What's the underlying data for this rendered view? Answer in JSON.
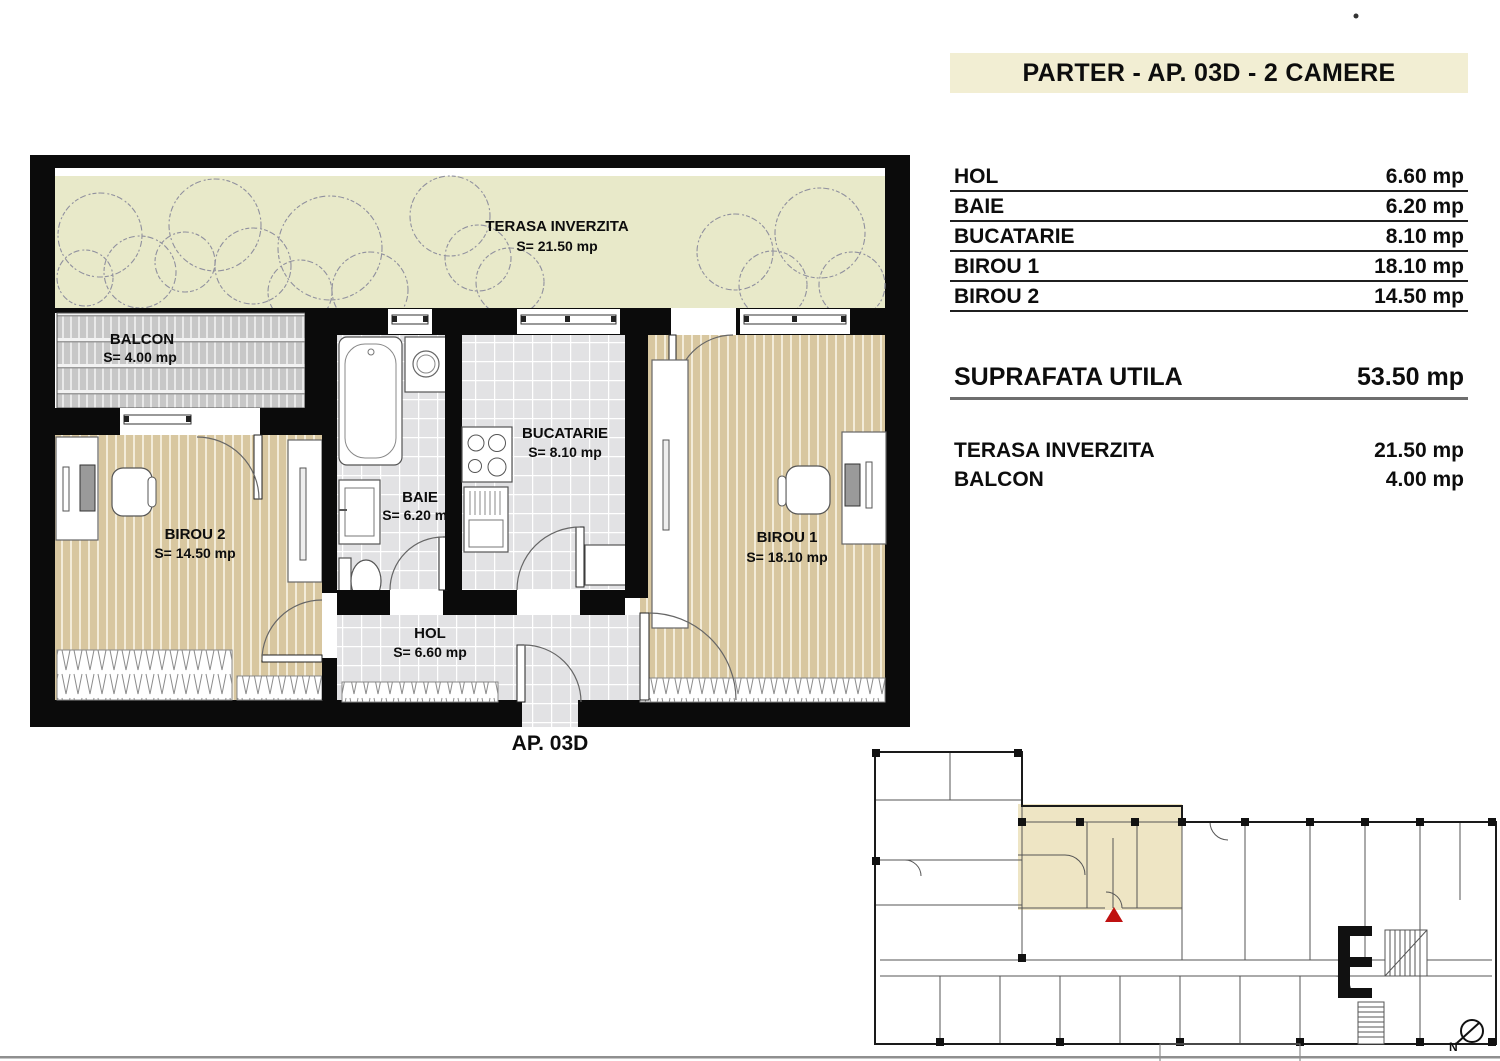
{
  "header": {
    "title": "PARTER - AP. 03D - 2 CAMERE"
  },
  "area_table": {
    "rows": [
      {
        "label": "HOL",
        "value": "6.60 mp"
      },
      {
        "label": "BAIE",
        "value": "6.20 mp"
      },
      {
        "label": "BUCATARIE",
        "value": "8.10 mp"
      },
      {
        "label": "BIROU 1",
        "value": "18.10 mp"
      },
      {
        "label": "BIROU 2",
        "value": "14.50 mp"
      }
    ],
    "summary": {
      "label": "SUPRAFATA UTILA",
      "value": "53.50 mp"
    },
    "extras": [
      {
        "label": "TERASA INVERZITA",
        "value": "21.50 mp"
      },
      {
        "label": "BALCON",
        "value": "4.00 mp"
      }
    ]
  },
  "plan": {
    "apartment_label": "AP. 03D",
    "rooms": {
      "terasa": {
        "name": "TERASA INVERZITA",
        "area": "S= 21.50 mp"
      },
      "balcon": {
        "name": "BALCON",
        "area": "S= 4.00 mp"
      },
      "birou2": {
        "name": "BIROU 2",
        "area": "S= 14.50 mp"
      },
      "baie": {
        "name": "BAIE",
        "area": "S= 6.20 mp"
      },
      "bucatarie": {
        "name": "BUCATARIE",
        "area": "S= 8.10 mp"
      },
      "birou1": {
        "name": "BIROU 1",
        "area": "S= 18.10 mp"
      },
      "hol": {
        "name": "HOL",
        "area": "S= 6.60 mp"
      }
    }
  },
  "minimap": {
    "north_label": "N"
  },
  "colors": {
    "banner_bg": "#f2eed3",
    "wall": "#0b0b0b",
    "terrace": "#e8e9c9",
    "wood_floor": "#d8c7a0",
    "tile_floor": "#e2e2e4",
    "balcony": "#c7c7c7",
    "minimap_highlight": "#ebe1ba",
    "marker_red": "#bf1111"
  }
}
